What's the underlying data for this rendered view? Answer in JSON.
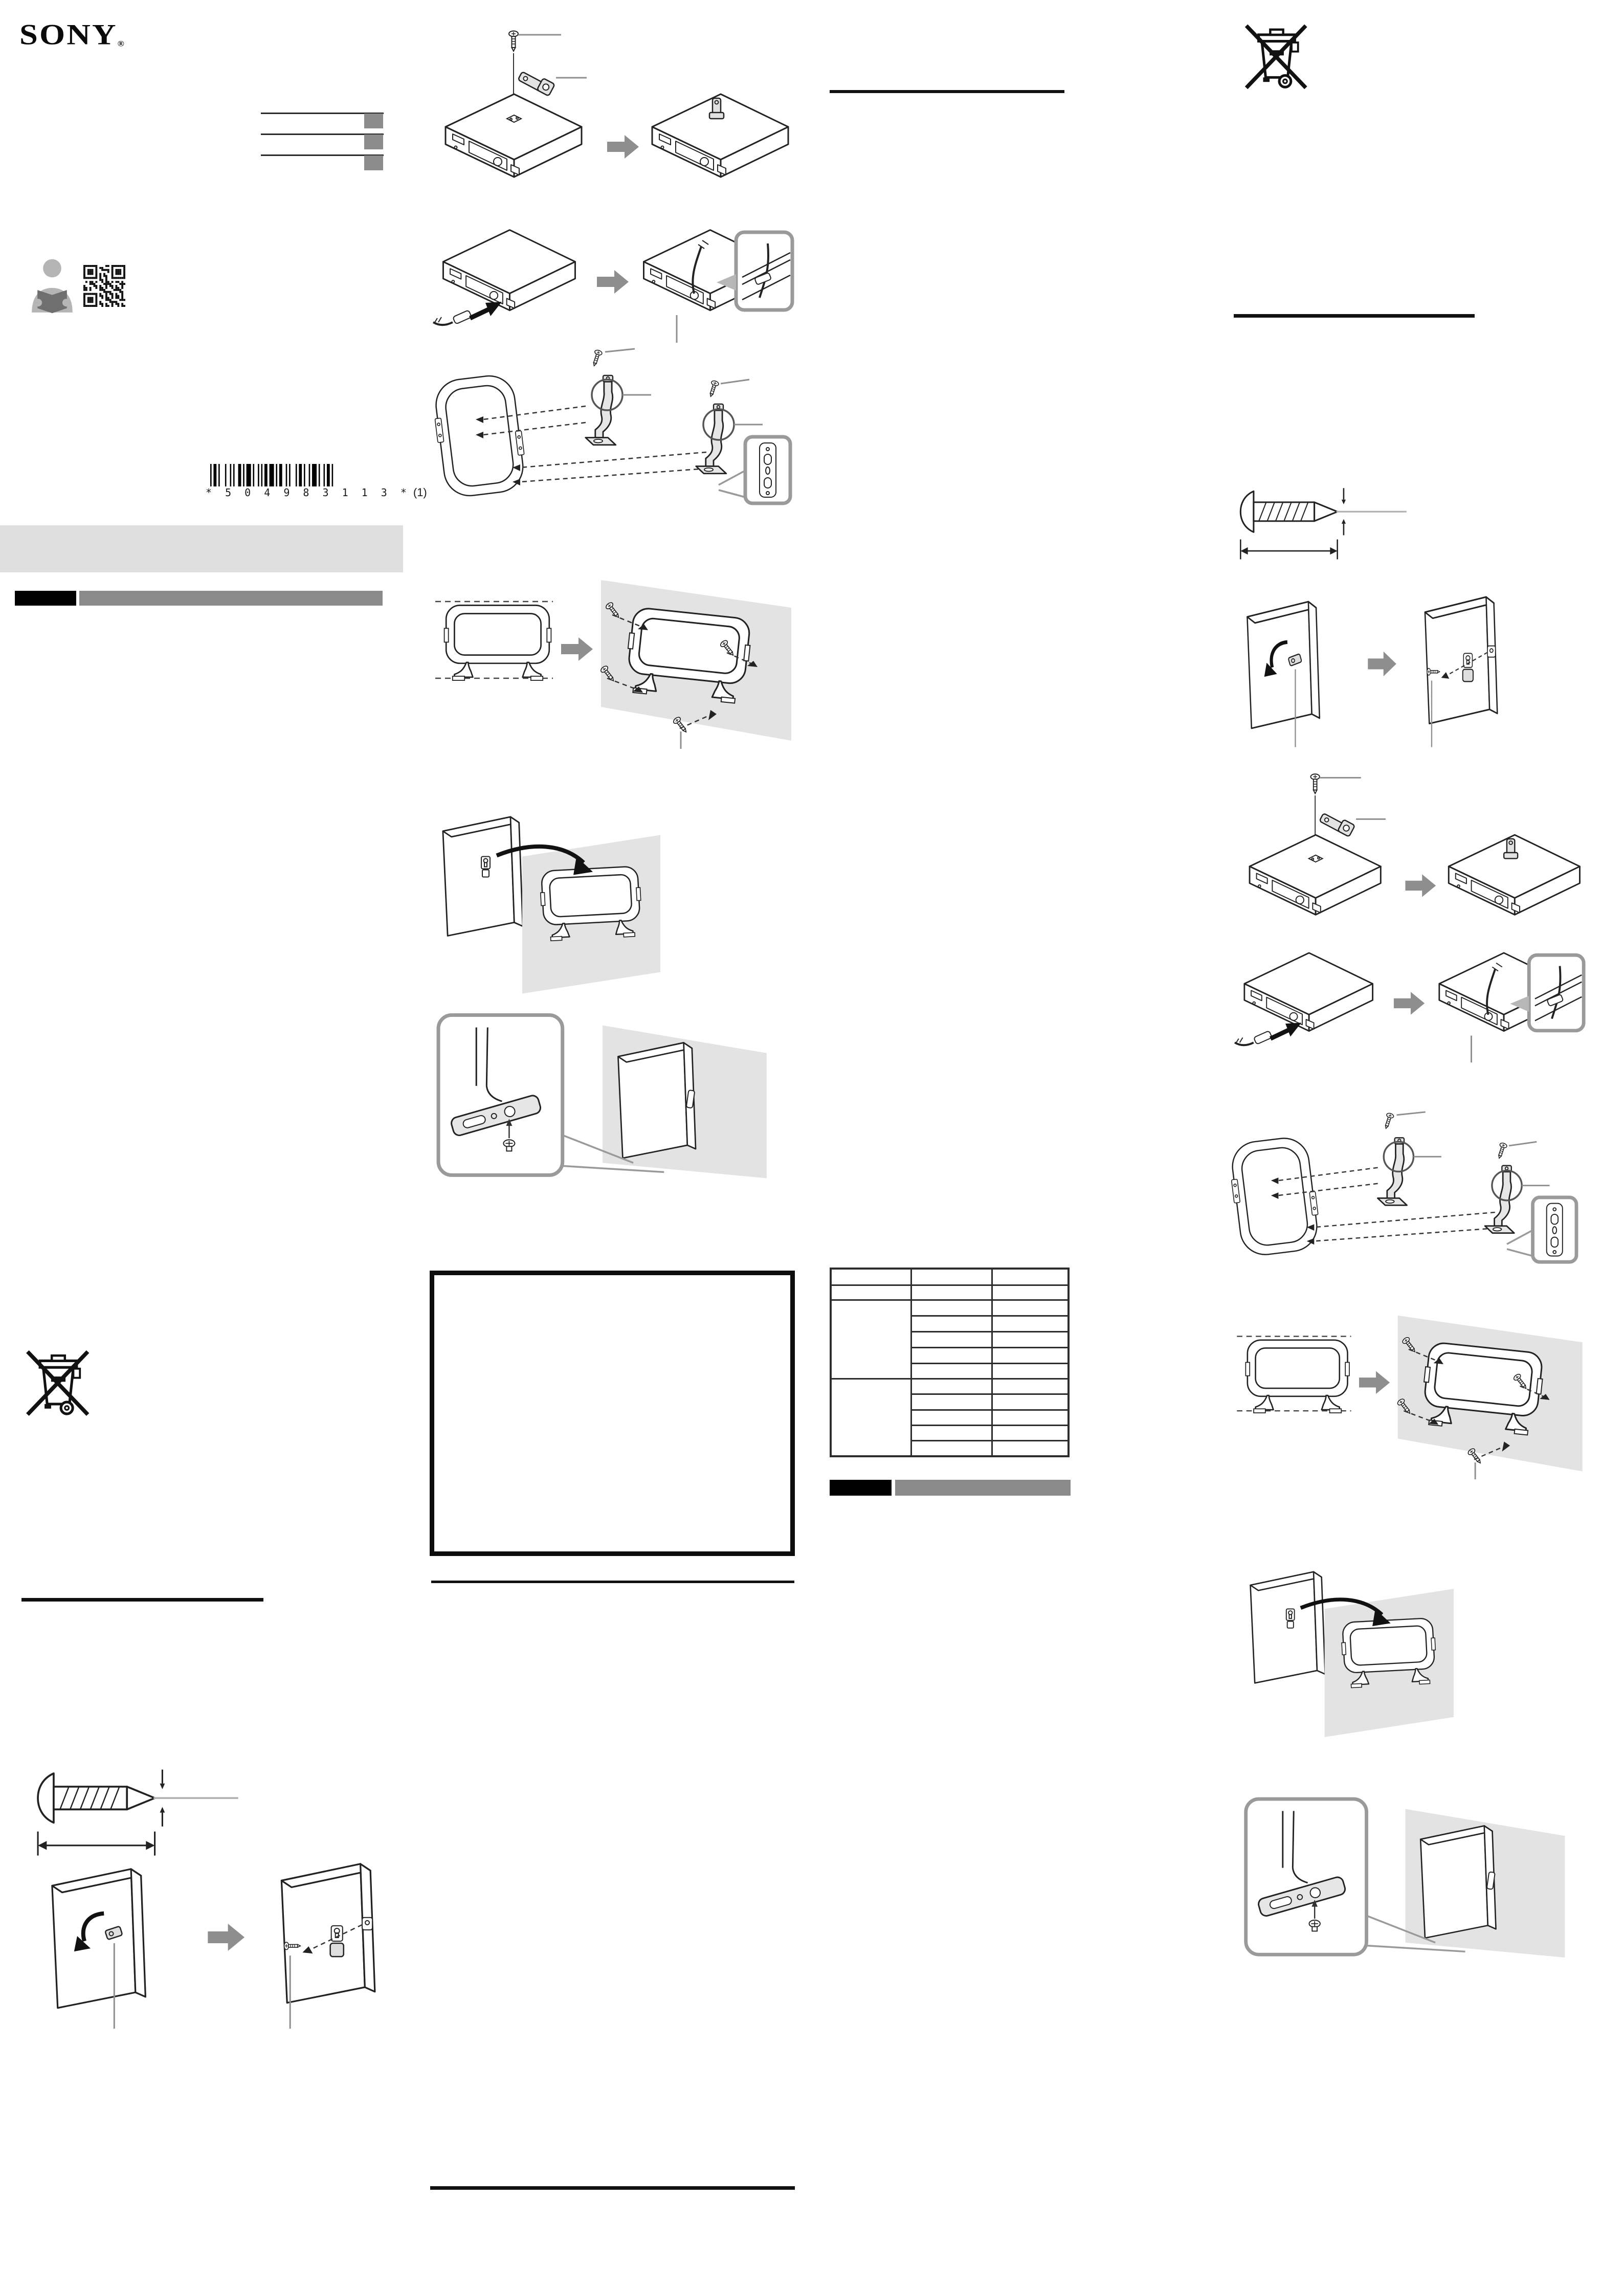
{
  "document": {
    "kind": "printed-instruction-leaflet",
    "page_background": "#ffffff"
  },
  "brand": {
    "logo": "SONY",
    "registered_mark": "®"
  },
  "barcode": {
    "digits": "* 5 0 4 9 8 3 1 1 3 *",
    "suffix": "(1)"
  },
  "colors": {
    "rule_black": "#111111",
    "section_bar_black": "#000000",
    "section_bar_gray": "#8a8a8a",
    "band_gray": "#dfdfdf",
    "title_square_gray": "#8c8c8c",
    "diagram_background_gray": "#e3e3e3",
    "block_arrow_gray": "#8e8e8e",
    "line_art_stroke": "#222222"
  },
  "icons": {
    "reader": "person-reading-manual-icon",
    "qr": "qr-code",
    "weee": "crossed-out-wheelie-bin-icon",
    "block_arrow": "step-arrow-icon",
    "screw": "mounting-screw",
    "bracket": "fixing-bracket",
    "antenna_frame": "loop-antenna-frame",
    "stand": "stand-leg",
    "wall": "wall-panel",
    "device": "tuner-unit"
  },
  "table": {
    "columns": 3,
    "header_rows": 1,
    "body_rows": 11,
    "merged_left_blocks": 2,
    "cells_contain_text": false
  },
  "diagrams": {
    "attach_bracket": "attach bracket to unit with screw",
    "route_cable": "route cable into unit with close-up inset",
    "attach_stands": "attach stand legs to antenna frame",
    "wall_mount_screws": "fix frame to wall with screws",
    "hang_on_wall": "hang frame onto wall bracket",
    "bracket_closeup": "bracket close-up and mounted side view",
    "rotate_bracket": "rotate rear bracket and insert screw",
    "screw_dimension": "screw with length and diameter dimensions"
  }
}
